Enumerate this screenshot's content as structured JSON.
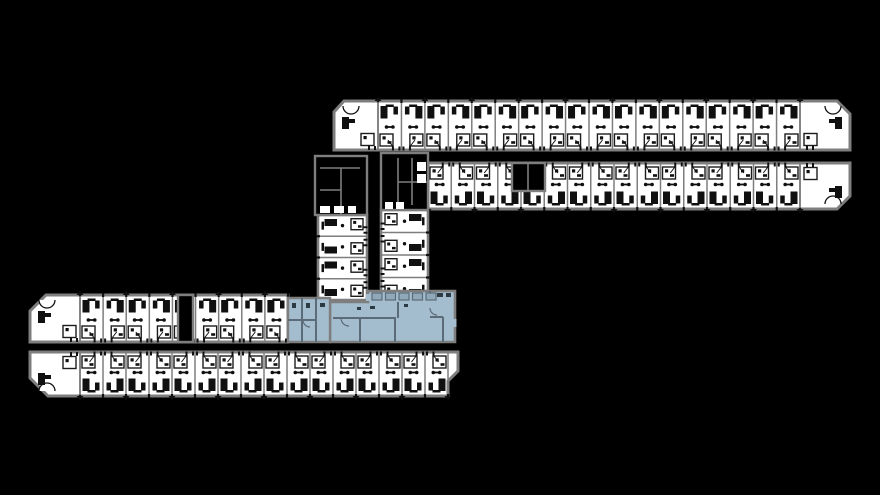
{
  "meta": {
    "kind": "architectural-floor-plan"
  },
  "canvas": {
    "w": 880,
    "h": 495,
    "bg": "#000000"
  },
  "palette": {
    "wall": "#7e7e7e",
    "room": "#ffffff",
    "ink": "#101010",
    "void": "#000000",
    "bathStroke": "#1c1c1c",
    "highlight": "#a3bdce",
    "highlightWall": "#5b6b78",
    "highlightFixture": "#8fa9ba",
    "highlightInk": "#2c3a44"
  },
  "rows": [
    {
      "id": "north-wing-upper-rooms",
      "outline": [
        [
          334,
          129
        ],
        [
          334,
          112
        ],
        [
          344,
          101
        ],
        [
          837,
          101
        ],
        [
          850,
          114
        ],
        [
          850,
          150
        ],
        [
          334,
          150
        ]
      ],
      "spanStart": 378,
      "spanEnd": 800,
      "roomCount": 18,
      "yTop": 101,
      "yBot": 150,
      "door": "bottom",
      "cornerLeft": {
        "x1": 334,
        "x2": 378
      },
      "cornerRight": {
        "x1": 800,
        "x2": 850
      }
    },
    {
      "id": "north-wing-lower-rooms",
      "outline": [
        [
          428,
          163
        ],
        [
          850,
          163
        ],
        [
          850,
          196
        ],
        [
          837,
          209
        ],
        [
          428,
          209
        ]
      ],
      "spanStart": 428,
      "spanEnd": 800,
      "roomCount": 16,
      "yTop": 163,
      "yBot": 209,
      "door": "top",
      "cornerRight": {
        "x1": 800,
        "x2": 850
      }
    },
    {
      "id": "south-wing-upper-rooms",
      "outline": [
        [
          30,
          311
        ],
        [
          46,
          295
        ],
        [
          288,
          295
        ],
        [
          288,
          342
        ],
        [
          30,
          342
        ]
      ],
      "spanStart": 80,
      "spanEnd": 288,
      "roomCount": 9,
      "yTop": 295,
      "yBot": 342,
      "door": "bottom",
      "cornerLeft": {
        "x1": 30,
        "x2": 80
      }
    },
    {
      "id": "south-wing-lower-rooms",
      "outline": [
        [
          30,
          352
        ],
        [
          458,
          352
        ],
        [
          458,
          371
        ],
        [
          448,
          381
        ],
        [
          448,
          396
        ],
        [
          48,
          396
        ],
        [
          30,
          378
        ]
      ],
      "spanStart": 80,
      "spanEnd": 448,
      "roomCount": 16,
      "yTop": 352,
      "yBot": 396,
      "door": "top",
      "cornerLeft": {
        "x1": 30,
        "x2": 80
      }
    }
  ],
  "stacks": [
    {
      "id": "connector-stack-west",
      "x1": 318,
      "x2": 367,
      "y1": 215,
      "y2": 300,
      "roomCount": 4,
      "door": "right"
    },
    {
      "id": "connector-stack-east",
      "x1": 381,
      "x2": 428,
      "y1": 210,
      "y2": 300,
      "roomCount": 4,
      "door": "left"
    }
  ],
  "cores": [
    {
      "id": "stair-core-west",
      "rect": [
        315,
        156,
        52,
        59
      ],
      "lines": [
        [
          320,
          168,
          360,
          168
        ],
        [
          341,
          168,
          341,
          214
        ],
        [
          320,
          190,
          341,
          190
        ]
      ],
      "whites": [
        [
          320,
          206,
          10,
          7
        ],
        [
          334,
          206,
          10,
          7
        ],
        [
          348,
          206,
          8,
          7
        ]
      ]
    },
    {
      "id": "stair-core-east",
      "rect": [
        381,
        153,
        47,
        57
      ],
      "lines": [
        [
          398,
          158,
          398,
          205
        ],
        [
          412,
          158,
          412,
          205
        ],
        [
          398,
          182,
          427,
          182
        ]
      ],
      "whites": [
        [
          417,
          162,
          9,
          9
        ],
        [
          417,
          174,
          9,
          9
        ],
        [
          385,
          202,
          8,
          7
        ],
        [
          396,
          202,
          8,
          7
        ]
      ]
    },
    {
      "id": "service-core-mid",
      "rect": [
        512,
        163,
        33,
        28
      ],
      "lines": [
        [
          528,
          163,
          528,
          190
        ]
      ],
      "whites": []
    },
    {
      "id": "entry-gap",
      "rect": [
        178,
        295,
        15,
        47
      ],
      "lines": [],
      "whites": []
    }
  ],
  "highlight": {
    "id": "highlighted-amenity-unit",
    "main": [
      [
        330,
        342
      ],
      [
        330,
        302
      ],
      [
        368,
        302
      ],
      [
        368,
        291
      ],
      [
        455,
        291
      ],
      [
        455,
        342
      ]
    ],
    "annex": [
      [
        288,
        298
      ],
      [
        330,
        298
      ],
      [
        330,
        342
      ],
      [
        288,
        342
      ]
    ],
    "walls": [
      [
        333,
        318,
        396,
        318
      ],
      [
        360,
        318,
        360,
        342
      ],
      [
        395,
        318,
        395,
        342
      ],
      [
        398,
        302,
        398,
        318
      ],
      [
        430,
        291,
        430,
        300
      ],
      [
        430,
        317,
        443,
        317
      ],
      [
        443,
        317,
        443,
        342
      ],
      [
        288,
        320,
        316,
        320
      ],
      [
        302,
        298,
        302,
        342
      ],
      [
        316,
        298,
        316,
        342
      ]
    ],
    "fixtures": {
      "x0": 372,
      "y": 293,
      "w": 10,
      "h": 7,
      "step": 13.5,
      "count": 5
    },
    "marks": [
      [
        437,
        293,
        6,
        4
      ],
      [
        446,
        293,
        5,
        4
      ],
      [
        370,
        306,
        5,
        3
      ],
      [
        404,
        304,
        4,
        3
      ],
      [
        357,
        307,
        4,
        3
      ],
      [
        292,
        303,
        4,
        5
      ],
      [
        306,
        303,
        4,
        5
      ],
      [
        320,
        303,
        5,
        4
      ]
    ],
    "doorGaps": [
      [
        452.5,
        319,
        4,
        8
      ],
      [
        366,
        294,
        4,
        7
      ]
    ],
    "arcs": [
      {
        "d": "M 341 318 A 8 8 0 0 0 349 326"
      },
      {
        "d": "M 303 320 A 7 7 0 0 0 310 327"
      },
      {
        "d": "M 430 308 A 7 7 0 0 0 437 315"
      }
    ]
  }
}
